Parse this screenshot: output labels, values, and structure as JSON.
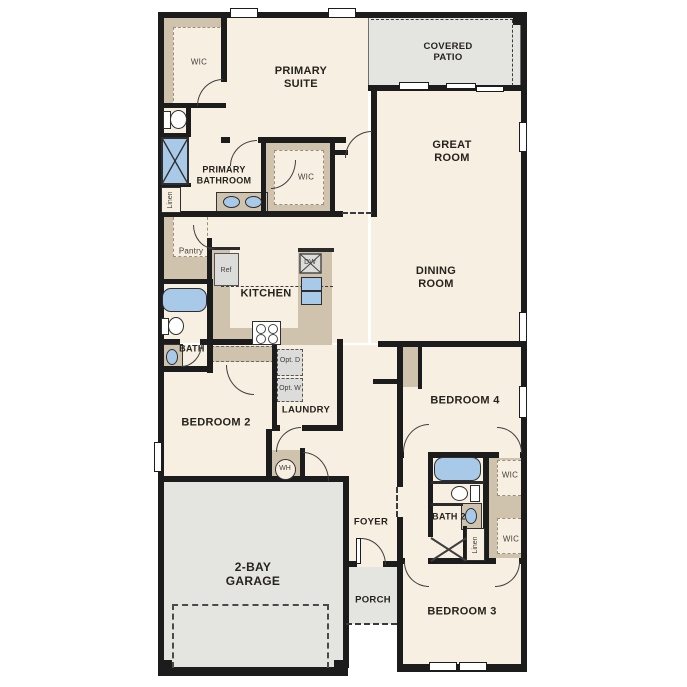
{
  "plan": {
    "type": "single-story residential floor plan",
    "labels": {
      "wic_primary": "WIC",
      "primary_suite": "PRIMARY SUITE",
      "covered_patio": "COVERED PATIO",
      "great_room": "GREAT ROOM",
      "primary_bathroom": "PRIMARY BATHROOM",
      "wic_primary_2": "WIC",
      "linen_primary": "Linen",
      "pantry": "Pantry",
      "ref": "Ref",
      "kitchen": "KITCHEN",
      "dw": "DW",
      "dining_room": "DINING ROOM",
      "bath_3": "BATH 3",
      "opt_d": "Opt. D",
      "opt_w": "Opt. W",
      "laundry": "LAUNDRY",
      "bedroom_2": "BEDROOM 2",
      "bedroom_4": "BEDROOM 4",
      "wh": "WH",
      "foyer": "FOYER",
      "garage": "2-BAY GARAGE",
      "porch": "PORCH",
      "bath_2": "BATH 2",
      "wic_bed4": "WIC",
      "wic_bed3": "WIC",
      "linen_bed3": "Linen",
      "bedroom_3": "BEDROOM 3"
    },
    "colors": {
      "wall": "#1c1c1c",
      "floor": "#f7efe2",
      "garage_patio": "#e4e4e1",
      "cabinet_tan": "#cfc3ad",
      "fixture_blue": "#a9c9e8",
      "appliance_gray": "#dcdcda"
    }
  }
}
